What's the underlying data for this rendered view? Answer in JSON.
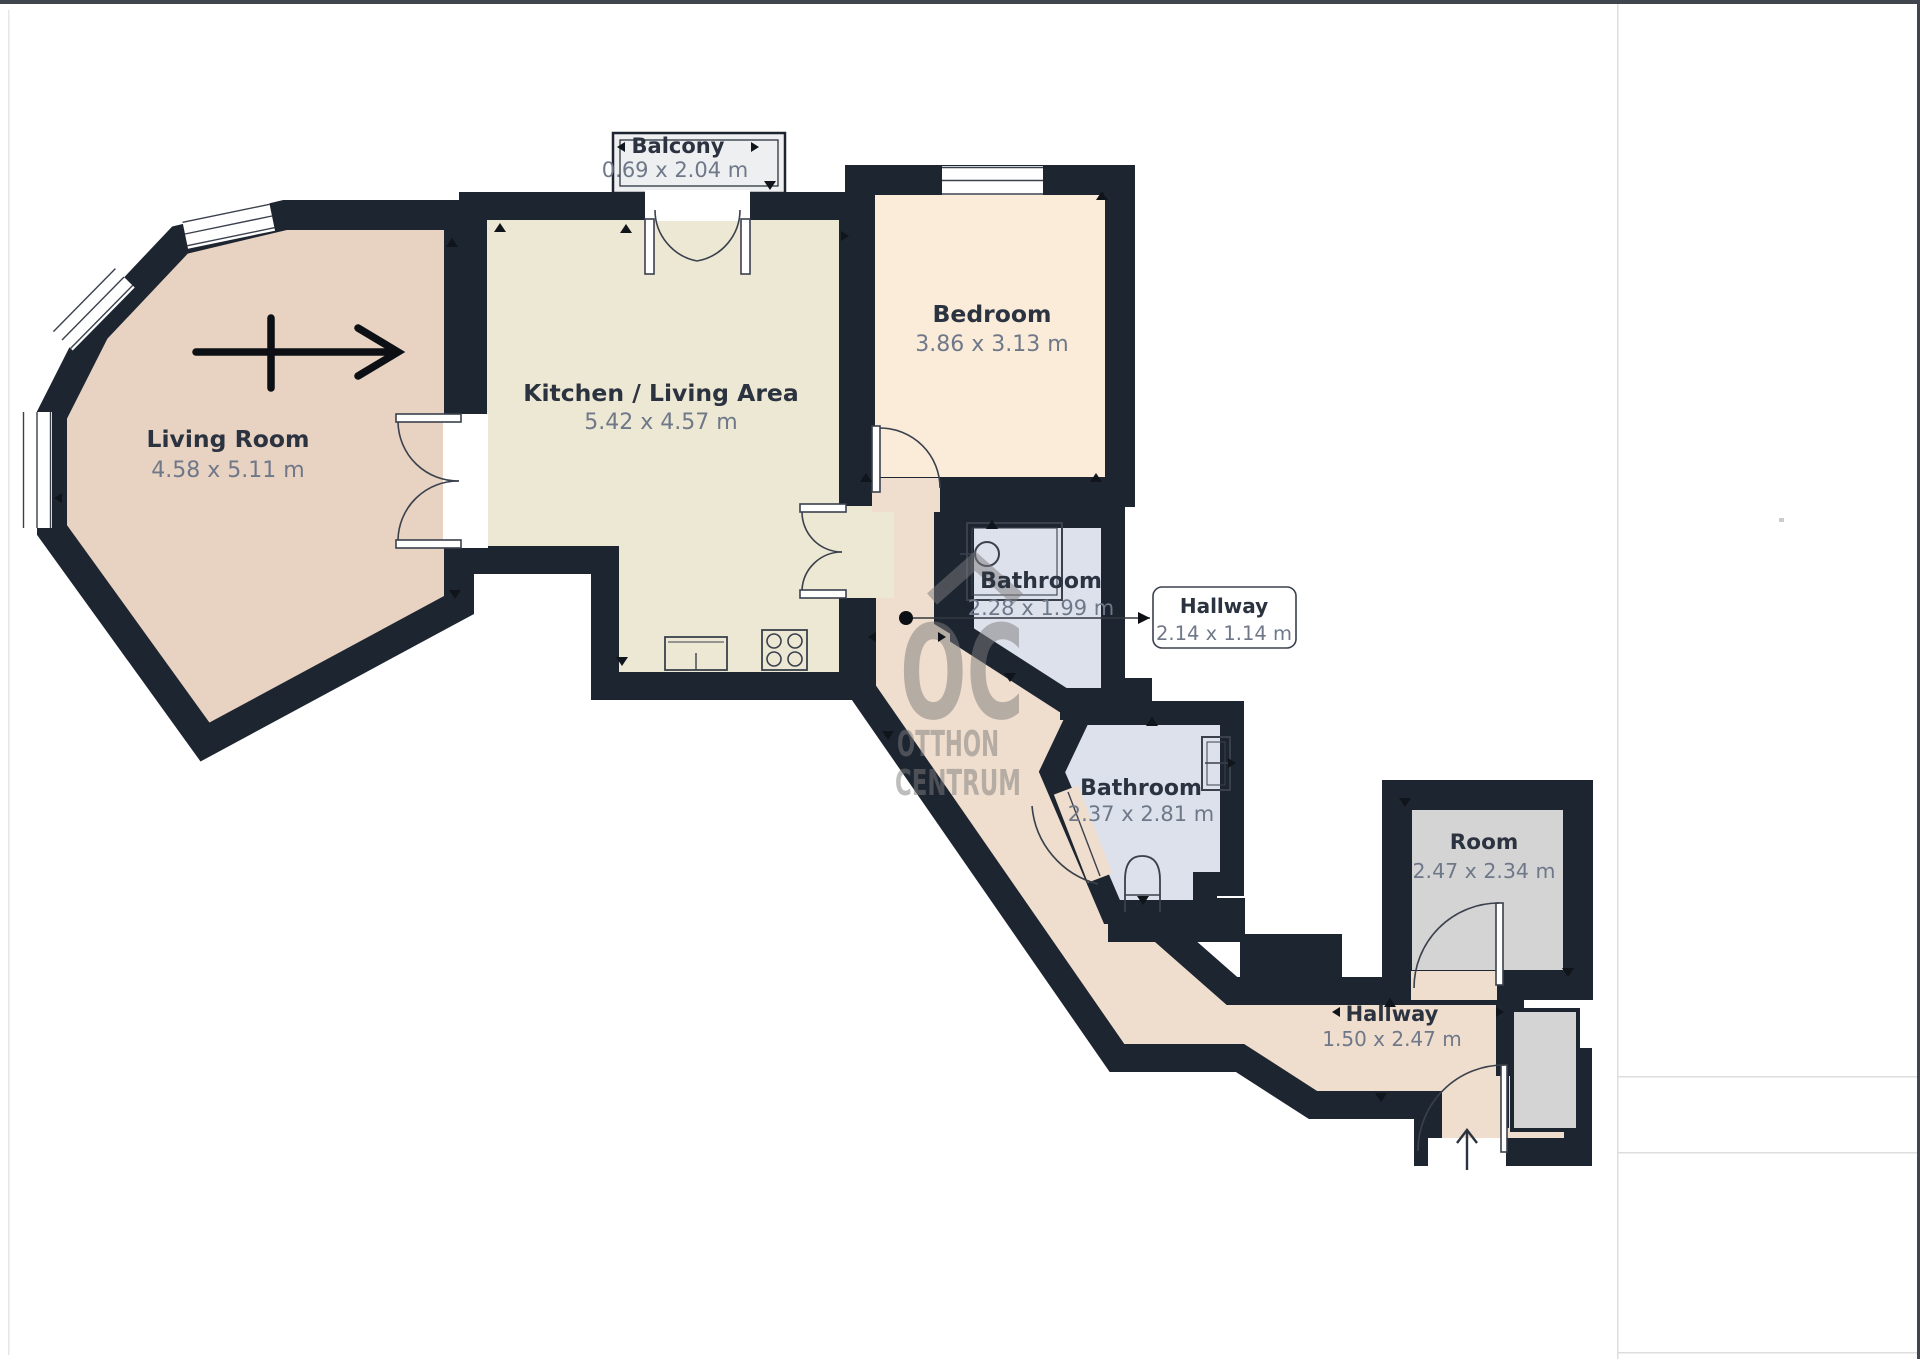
{
  "window_chrome": {
    "top_edge_color": "#41464e",
    "right_edge_color": "#41464e",
    "panel_line_color": "#dedede"
  },
  "floorplan": {
    "wall_color": "#1d2531",
    "annotation_color": "#10141b",
    "rooms": [
      {
        "name": "Living Room",
        "dims": "4.58 x 5.11 m",
        "fill": "#e8d2c2"
      },
      {
        "name": "Kitchen / Living Area",
        "dims": "5.42 x 4.57 m",
        "fill": "#ede8d3"
      },
      {
        "name": "Bedroom",
        "dims": "3.86 x 3.13 m",
        "fill": "#faecd9"
      },
      {
        "name": "Balcony",
        "dims": "0.69 x 2.04 m",
        "fill": "#edeff1"
      },
      {
        "name": "Bathroom",
        "dims": "2.28 x 1.99 m",
        "fill": "#dde1eb"
      },
      {
        "name": "Hallway",
        "dims": "2.14 x 1.14 m",
        "fill": "#efddcd"
      },
      {
        "name": "Bathroom",
        "dims": "2.37 x 2.81 m",
        "fill": "#dde1eb"
      },
      {
        "name": "Room",
        "dims": "2.47 x 2.34 m",
        "fill": "#d4d4d4"
      },
      {
        "name": "Hallway",
        "dims": "1.50 x 2.47 m",
        "fill": "#efddcd"
      }
    ],
    "watermark": {
      "abbr": "OC",
      "line1": "OTTHON",
      "line2": "CENTRUM",
      "color": "#7d7d7d"
    }
  }
}
